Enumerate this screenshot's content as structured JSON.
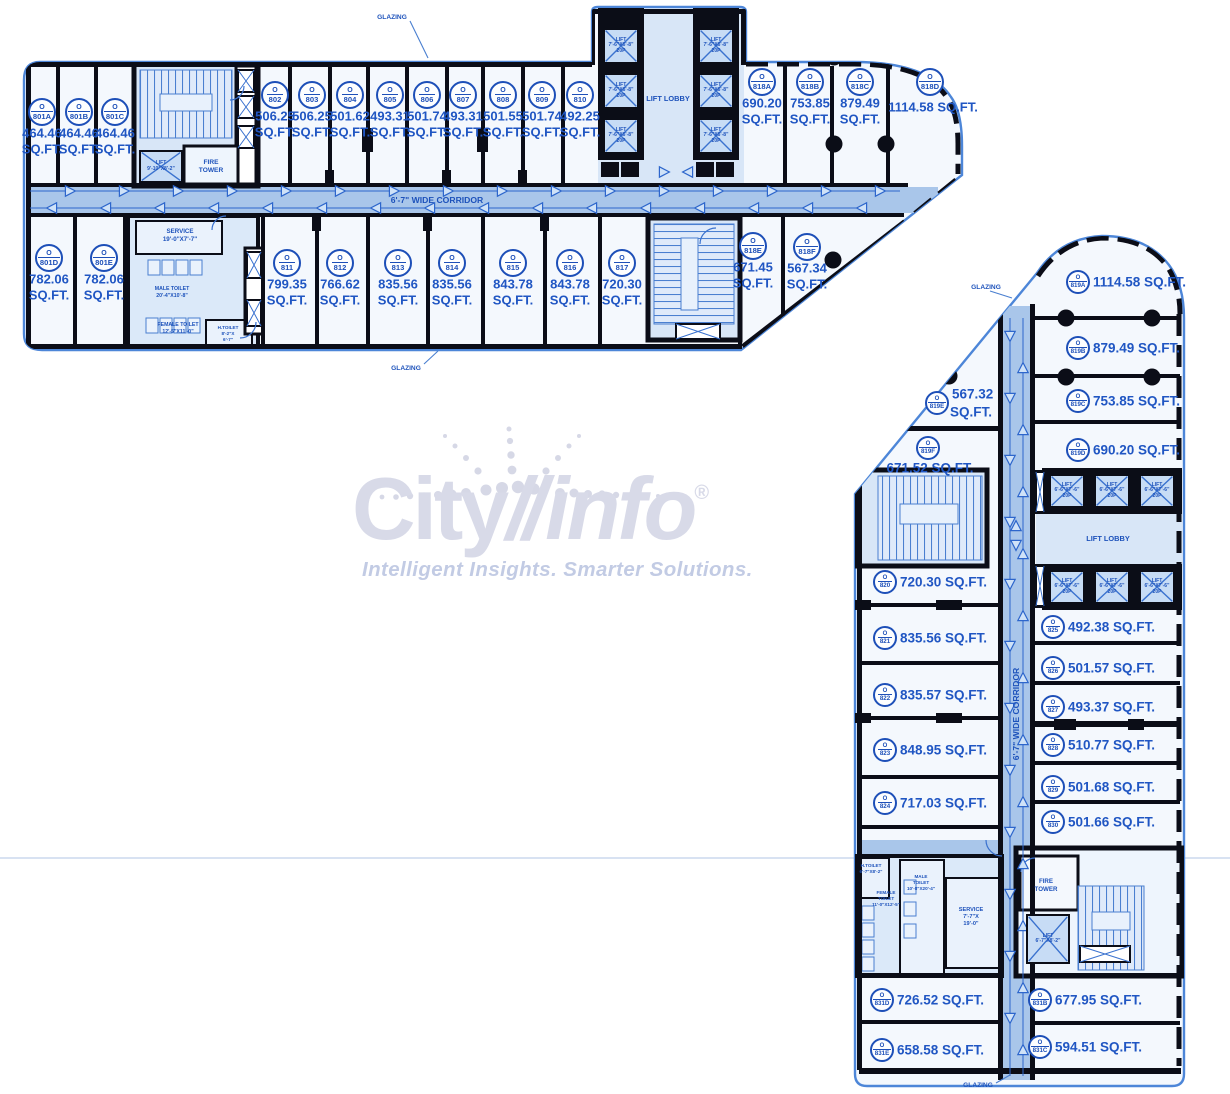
{
  "watermark": {
    "brand_left": "City",
    "brand_right": "info",
    "reg": "®",
    "tagline": "Intelligent Insights. Smarter Solutions."
  },
  "labels": {
    "o": "O",
    "sqft": "SQ.FT.",
    "corridor": "6'-7\" WIDE CORRIDOR",
    "lift_lobby": "LIFT LOBBY",
    "glazing": "GLAZING",
    "fire_tower": [
      "FIRE",
      "TOWER"
    ],
    "service_n": [
      "SERVICE",
      "19'-0\"X7'-7\""
    ],
    "male_toilet_n": [
      "MALE TOILET",
      "20'-4\"X10'-8\""
    ],
    "female_toilet_n": [
      "FEMALE TOILET",
      "12'-5\"X11'-0\""
    ],
    "h_toilet_n": [
      "H.TOILET",
      "8'-2\"X",
      "6'-7\""
    ],
    "service_e": [
      "SERVICE",
      "7'-7\"X",
      "19'-0\""
    ],
    "male_toilet_e": [
      "MALE",
      "TOILET",
      "10'-8\"X20'-4\""
    ],
    "female_toilet_e": [
      "FEMALE",
      "TOILET",
      "11'-0\"X12'-5\""
    ],
    "h_toilet_e": [
      "H.TOILET",
      "6'-7\"X8'-2\""
    ],
    "lift_bank_n": [
      "LIFT",
      "7'-6\"X6'-8\"",
      "20P"
    ],
    "lift_bank_e": [
      "LIFT",
      "6'-6\"X7'-6\"",
      "20P"
    ],
    "lift_small_n": [
      "LIFT",
      "9'-10\"X8'-2\""
    ],
    "lift_small_e": [
      "LIFT",
      "6'-7\"X8'-2\""
    ]
  },
  "colors": {
    "ink_blue": "#1d52bb",
    "wall_black": "#0b0d17",
    "corridor_blue": "#a9c6ea",
    "room_fill": "#f4f8fd",
    "watermark_gray": "#d8dae8"
  },
  "units": [
    {
      "id": "801A",
      "area": "464.46",
      "layout": "v2",
      "w": "n",
      "x": 42,
      "y": 112
    },
    {
      "id": "801B",
      "area": "464.46",
      "layout": "v2",
      "w": "n",
      "x": 79,
      "y": 112
    },
    {
      "id": "801C",
      "area": "464.46",
      "layout": "v2",
      "w": "n",
      "x": 115,
      "y": 112
    },
    {
      "id": "802",
      "area": "506.25",
      "layout": "v2",
      "w": "n",
      "x": 275,
      "y": 95
    },
    {
      "id": "803",
      "area": "506.25",
      "layout": "v2",
      "w": "n",
      "x": 312,
      "y": 95
    },
    {
      "id": "804",
      "area": "501.62",
      "layout": "v2",
      "w": "n",
      "x": 350,
      "y": 95
    },
    {
      "id": "805",
      "area": "493.31",
      "layout": "v2",
      "w": "n",
      "x": 390,
      "y": 95
    },
    {
      "id": "806",
      "area": "501.74",
      "layout": "v2",
      "w": "n",
      "x": 427,
      "y": 95
    },
    {
      "id": "807",
      "area": "493.31",
      "layout": "v2",
      "w": "n",
      "x": 463,
      "y": 95
    },
    {
      "id": "808",
      "area": "501.55",
      "layout": "v2",
      "w": "n",
      "x": 503,
      "y": 95
    },
    {
      "id": "809",
      "area": "501.74",
      "layout": "v2",
      "w": "n",
      "x": 542,
      "y": 95
    },
    {
      "id": "810",
      "area": "492.25",
      "layout": "v2",
      "w": "n",
      "x": 580,
      "y": 95
    },
    {
      "id": "818A",
      "area": "690.20",
      "layout": "v2",
      "w": "n",
      "x": 762,
      "y": 82
    },
    {
      "id": "818B",
      "area": "753.85",
      "layout": "v2",
      "w": "n",
      "x": 810,
      "y": 82
    },
    {
      "id": "818C",
      "area": "879.49",
      "layout": "v2",
      "w": "n",
      "x": 860,
      "y": 82
    },
    {
      "id": "818D",
      "area": "1114.58",
      "layout": "v1",
      "w": "n",
      "x": 930,
      "y": 82,
      "tx": 933,
      "ty": 107
    },
    {
      "id": "801D",
      "area": "782.06",
      "layout": "v2",
      "w": "n",
      "x": 49,
      "y": 258
    },
    {
      "id": "801E",
      "area": "782.06",
      "layout": "v2",
      "w": "n",
      "x": 104,
      "y": 258
    },
    {
      "id": "811",
      "area": "799.35",
      "layout": "v2",
      "w": "n",
      "x": 287,
      "y": 263
    },
    {
      "id": "812",
      "area": "766.62",
      "layout": "v2",
      "w": "n",
      "x": 340,
      "y": 263
    },
    {
      "id": "813",
      "area": "835.56",
      "layout": "v2",
      "w": "n",
      "x": 398,
      "y": 263
    },
    {
      "id": "814",
      "area": "835.56",
      "layout": "v2",
      "w": "n",
      "x": 452,
      "y": 263
    },
    {
      "id": "815",
      "area": "843.78",
      "layout": "v2",
      "w": "n",
      "x": 513,
      "y": 263
    },
    {
      "id": "816",
      "area": "843.78",
      "layout": "v2",
      "w": "n",
      "x": 570,
      "y": 263
    },
    {
      "id": "817",
      "area": "720.30",
      "layout": "v2",
      "w": "n",
      "x": 622,
      "y": 263
    },
    {
      "id": "818E",
      "area": "671.45",
      "layout": "v2",
      "w": "n",
      "x": 753,
      "y": 246
    },
    {
      "id": "818F",
      "area": "567.34",
      "layout": "v2",
      "w": "n",
      "x": 807,
      "y": 247
    },
    {
      "id": "819A",
      "area": "1114.58",
      "layout": "h1",
      "w": "e",
      "x": 1078,
      "y": 282
    },
    {
      "id": "819B",
      "area": "879.49",
      "layout": "h1",
      "w": "e",
      "x": 1078,
      "y": 348
    },
    {
      "id": "819C",
      "area": "753.85",
      "layout": "h1",
      "w": "e",
      "x": 1078,
      "y": 401
    },
    {
      "id": "819D",
      "area": "690.20",
      "layout": "h1",
      "w": "e",
      "x": 1078,
      "y": 450
    },
    {
      "id": "819E",
      "area": "567.32",
      "layout": "h2",
      "w": "e",
      "x": 937,
      "y": 403
    },
    {
      "id": "819F",
      "area": "671.52",
      "layout": "v1",
      "w": "e",
      "x": 928,
      "y": 448,
      "tx": 930,
      "ty": 468
    },
    {
      "id": "820",
      "area": "720.30",
      "layout": "h1",
      "w": "e",
      "x": 885,
      "y": 582
    },
    {
      "id": "821",
      "area": "835.56",
      "layout": "h1",
      "w": "e",
      "x": 885,
      "y": 638
    },
    {
      "id": "822",
      "area": "835.57",
      "layout": "h1",
      "w": "e",
      "x": 885,
      "y": 695
    },
    {
      "id": "823",
      "area": "848.95",
      "layout": "h1",
      "w": "e",
      "x": 885,
      "y": 750
    },
    {
      "id": "824",
      "area": "717.03",
      "layout": "h1",
      "w": "e",
      "x": 885,
      "y": 803
    },
    {
      "id": "825",
      "area": "492.38",
      "layout": "h1",
      "w": "e",
      "x": 1053,
      "y": 627
    },
    {
      "id": "826",
      "area": "501.57",
      "layout": "h1",
      "w": "e",
      "x": 1053,
      "y": 668
    },
    {
      "id": "827",
      "area": "493.37",
      "layout": "h1",
      "w": "e",
      "x": 1053,
      "y": 707
    },
    {
      "id": "828",
      "area": "510.77",
      "layout": "h1",
      "w": "e",
      "x": 1053,
      "y": 745
    },
    {
      "id": "829",
      "area": "501.68",
      "layout": "h1",
      "w": "e",
      "x": 1053,
      "y": 787
    },
    {
      "id": "830",
      "area": "501.66",
      "layout": "h1",
      "w": "e",
      "x": 1053,
      "y": 822
    },
    {
      "id": "831D",
      "area": "726.52",
      "layout": "h1",
      "w": "e",
      "x": 882,
      "y": 1000
    },
    {
      "id": "831E",
      "area": "658.58",
      "layout": "h1",
      "w": "e",
      "x": 882,
      "y": 1050
    },
    {
      "id": "831B",
      "area": "677.95",
      "layout": "h1",
      "w": "e",
      "x": 1040,
      "y": 1000
    },
    {
      "id": "831C",
      "area": "594.51",
      "layout": "h1",
      "w": "e",
      "x": 1040,
      "y": 1047
    }
  ],
  "lifts": [
    {
      "x": 603,
      "y": 28,
      "w": 36,
      "h": 36,
      "l": "lift_bank_n"
    },
    {
      "x": 603,
      "y": 73,
      "w": 36,
      "h": 36,
      "l": "lift_bank_n"
    },
    {
      "x": 603,
      "y": 118,
      "w": 36,
      "h": 36,
      "l": "lift_bank_n"
    },
    {
      "x": 698,
      "y": 28,
      "w": 36,
      "h": 36,
      "l": "lift_bank_n"
    },
    {
      "x": 698,
      "y": 73,
      "w": 36,
      "h": 36,
      "l": "lift_bank_n"
    },
    {
      "x": 698,
      "y": 118,
      "w": 36,
      "h": 36,
      "l": "lift_bank_n"
    },
    {
      "x": 1049,
      "y": 474,
      "w": 36,
      "h": 34,
      "l": "lift_bank_e"
    },
    {
      "x": 1094,
      "y": 474,
      "w": 36,
      "h": 34,
      "l": "lift_bank_e"
    },
    {
      "x": 1139,
      "y": 474,
      "w": 36,
      "h": 34,
      "l": "lift_bank_e"
    },
    {
      "x": 1049,
      "y": 570,
      "w": 36,
      "h": 34,
      "l": "lift_bank_e"
    },
    {
      "x": 1094,
      "y": 570,
      "w": 36,
      "h": 34,
      "l": "lift_bank_e"
    },
    {
      "x": 1139,
      "y": 570,
      "w": 36,
      "h": 34,
      "l": "lift_bank_e"
    },
    {
      "x": 139,
      "y": 150,
      "w": 44,
      "h": 33,
      "l": "lift_small_n"
    },
    {
      "x": 1026,
      "y": 914,
      "w": 44,
      "h": 50,
      "l": "lift_small_e"
    }
  ]
}
